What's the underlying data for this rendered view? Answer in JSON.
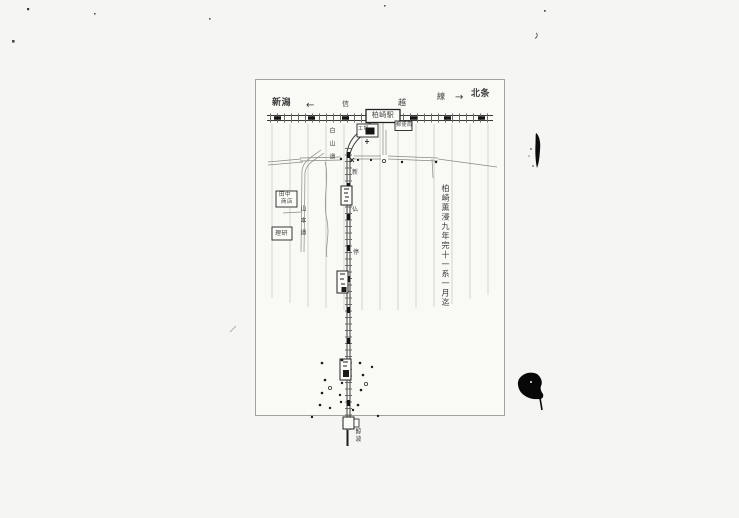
{
  "page": {
    "background": "#f5f5f3",
    "paper_background": "#f9f9f6",
    "ink_color": "#2b2b2b",
    "grid_color": "#c9c9c3",
    "kind": "scanned hand-drawn railway sketch map"
  },
  "map": {
    "direction_left": "新潟",
    "arrow_left": "←",
    "rail_char_shin": "信",
    "rail_char_etsu": "越",
    "rail_char_sen": "線",
    "arrow_right": "→",
    "direction_right": "北条",
    "main_station": "柏崎駅",
    "factory_box": "工場",
    "office_box": "郵便局",
    "shop_box_line1": "田中",
    "shop_box_line2": "商店",
    "lab_box": "理研",
    "road_text_center": "白山道",
    "road_text_left": "山本道",
    "branch_char_1": "新",
    "branch_char_2": "仏",
    "branch_char_3": "停",
    "bottom_station": "鯨波",
    "right_note_vertical": "柏崎薫浸九年完十一系一月迄"
  }
}
